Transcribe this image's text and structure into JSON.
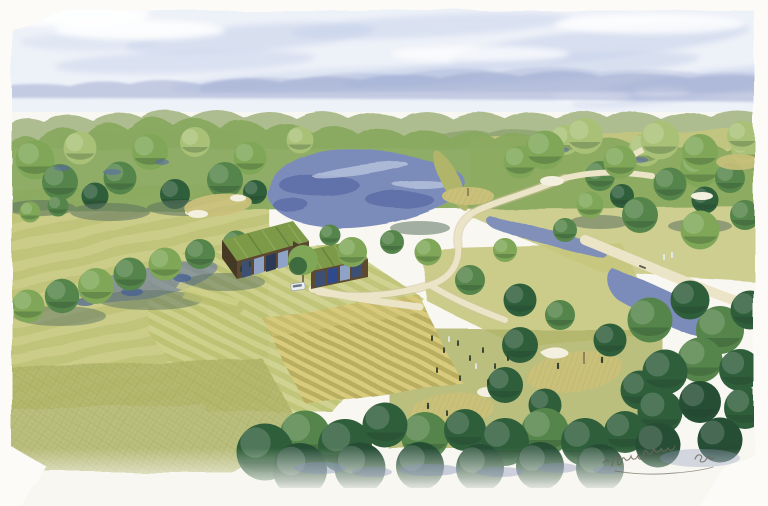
{
  "artwork": {
    "medium": "watercolor",
    "view": "aerial-perspective",
    "subject": "Watercolor aerial view of a golf course landscape: green-roofed modern clubhouse, river ponds, winding cream cart paths, striped mown lawns, putting greens with white sand bunkers, dense broadleaf trees, distant blue mountains under a pale washed sky",
    "signature": {
      "present": true,
      "legible": false,
      "location": "bottom-right"
    }
  },
  "palette": {
    "paper": "#f8f7f1",
    "sky": "#edf1f8",
    "cloud": "#c4cfe9",
    "mountain": "#9aa6ce",
    "distant_tree": "#a9b98a",
    "distant_tree_dark": "#8fa470",
    "tree_light": "#a9c177",
    "tree_mid": "#7fa757",
    "tree_dark": "#55854a",
    "tree_deep": "#2f5e3a",
    "tree_deepest": "#264e35",
    "shadow_slate": "#5d7262",
    "shadow_blue": "#8b97bb",
    "water": "#7b8cba",
    "water_dark": "#5a6ca6",
    "water_light": "#b8c3de",
    "fairway": "#c6c77e",
    "fairway_light": "#d9d79c",
    "fairway_dark": "#b0b56a",
    "field_gold": "#d6c97b",
    "field_gold_dark": "#b9ae5e",
    "path": "#ece4c7",
    "path_edge": "#cfc49b",
    "sand": "#f4f0e0",
    "green_tan": "#c9c07a",
    "roof_green": "#7d9a48",
    "roof_green_light": "#93ad5c",
    "wall_brown": "#5b4a30",
    "glass_blue": "#3e4f74",
    "glass_glint": "#8fa3c6",
    "car_white": "#eceff2",
    "figure_dark": "#33402f",
    "figure_white": "#e3e8ee",
    "signature_ink": "#6b675c"
  }
}
